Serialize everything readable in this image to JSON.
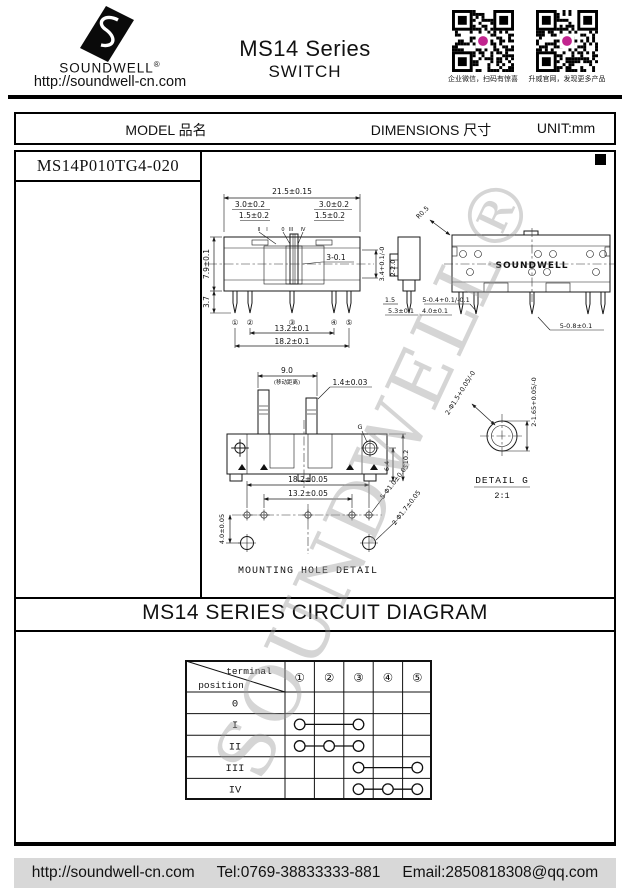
{
  "header": {
    "brand": "SOUNDWELL",
    "brand_reg": "®",
    "website": "http://soundwell-cn.com",
    "series_title": "MS14 Series",
    "product_type": "SWITCH",
    "qr_codes": [
      {
        "caption": "企业微信，扫码有惊喜"
      },
      {
        "caption": "升威官网，发现更多产品"
      }
    ]
  },
  "info_bar": {
    "model_label": "MODEL 品名",
    "dimensions_label": "DIMENSIONS 尺寸",
    "unit_label": "UNIT:mm"
  },
  "model_name": "MS14P010TG4-020",
  "watermark": "SOUNDWELL®",
  "drawing": {
    "front_view": {
      "overall_width": "21.5±0.15",
      "dim_30_left": "3.0±0.2",
      "dim_30_right": "3.0±0.2",
      "dim_15_left": "1.5±0.2",
      "dim_15_right": "1.5±0.2",
      "positions": [
        "II",
        "I",
        "0",
        "III",
        "IV"
      ],
      "knob_dim": "3-0.1",
      "height_dim": "3.4+0.1/-0",
      "body_height": "7.9±0.1",
      "pin_length": "3.7",
      "terminals": [
        "①",
        "②",
        "③",
        "④",
        "⑤"
      ],
      "pin_span_inner": "13.2±0.1",
      "pin_span_outer": "18.2±0.1"
    },
    "side_view": {
      "radius": "R0.5",
      "dim_2_20": "2-2.0",
      "dim_15": "1.5",
      "dim_53": "5.3±0.1",
      "dim_40": "4.0±0.1",
      "pin_dim": "5-0.4+0.1/-0.1"
    },
    "back_view": {
      "brand": "SOUNDWELL",
      "pin_dim": "5-0.8±0.1"
    },
    "travel_view": {
      "travel": "9.0",
      "travel_note": "(移动距离)",
      "knob_width": "1.4±0.03",
      "total_height": "10.2",
      "body_height": "6.4",
      "g_ref": "G"
    },
    "detail_g": {
      "hole_dia": "2-Φ1.5+0.05/-0",
      "hole_pitch": "2-1.65+0.05/-0",
      "title": "DETAIL G",
      "scale": "2:1"
    },
    "mounting": {
      "span_outer": "18.2±0.05",
      "span_inner": "13.2±0.05",
      "offset": "4.0±0.05",
      "small_holes": "5-Φ1.0±0.05",
      "large_holes": "2-Φ1.7±0.05",
      "caption": "MOUNTING HOLE DETAIL"
    }
  },
  "circuit": {
    "title": "MS14 SERIES CIRCUIT DIAGRAM",
    "corner_terminal": "terminal",
    "corner_position": "position",
    "terminals": [
      "①",
      "②",
      "③",
      "④",
      "⑤"
    ],
    "rows": [
      {
        "label": "0",
        "connected": []
      },
      {
        "label": "I",
        "connected": [
          1,
          3
        ]
      },
      {
        "label": "II",
        "connected": [
          1,
          2,
          3
        ]
      },
      {
        "label": "III",
        "connected": [
          3,
          5
        ]
      },
      {
        "label": "IV",
        "connected": [
          3,
          4,
          5
        ]
      }
    ]
  },
  "footer": {
    "website": "http://soundwell-cn.com",
    "tel": "Tel:0769-38833333-881",
    "email": "Email:2850818308@qq.com"
  }
}
